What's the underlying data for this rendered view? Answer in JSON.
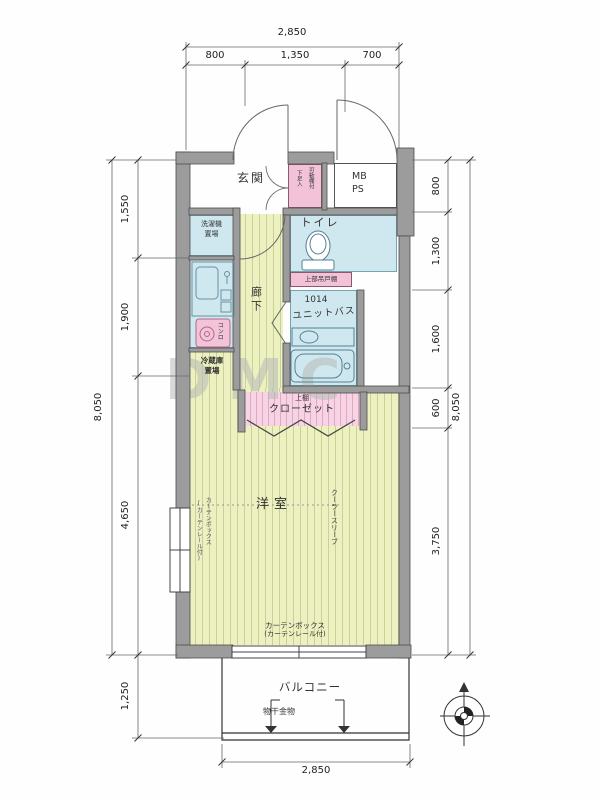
{
  "watermark": "DMC",
  "dims": {
    "top": {
      "total": "2,850",
      "segs": [
        "800",
        "1,350",
        "700"
      ]
    },
    "bottom": {
      "total": "2,850"
    },
    "left": {
      "total": "8,050",
      "segs": [
        "1,550",
        "1,900",
        "4,650",
        "1,250"
      ]
    },
    "right": {
      "total": "8,050",
      "segs": [
        "800",
        "1,300",
        "1,600",
        "600",
        "3,750"
      ]
    }
  },
  "rooms": {
    "genkan": "玄関",
    "corridor": "廊下",
    "toilet": "トイレ",
    "bath_size": "1014",
    "bath": "ユニットバス",
    "room": "洋室",
    "balcony": "バルコニー",
    "closet": "クローゼット",
    "mb": "MB",
    "ps": "PS"
  },
  "fixtures": {
    "laundry_l1": "洗濯機",
    "laundry_l2": "置場",
    "fridge_l1": "冷蔵庫",
    "fridge_l2": "置場",
    "stove": "コンロ",
    "shoebox_col1": "可動棚付",
    "shoebox_col2": "下足入",
    "hanging_cabinet": "上部吊戸棚",
    "closet_shelf": "上棚",
    "curtain_l1": "カーテンボックス",
    "curtain_l2": "(カーテンレール付)",
    "window_note_col1": "カーテンボックス",
    "window_note_col2": "(カーテンレール付)",
    "ac_sleeve": "クーラースリーブ",
    "drying": "物干金物"
  },
  "colors": {
    "wall": "#9c9c9c",
    "floor_yellow": "#edf0c0",
    "room_blue": "#cfe8f0",
    "pink": "#f2c3d8"
  }
}
